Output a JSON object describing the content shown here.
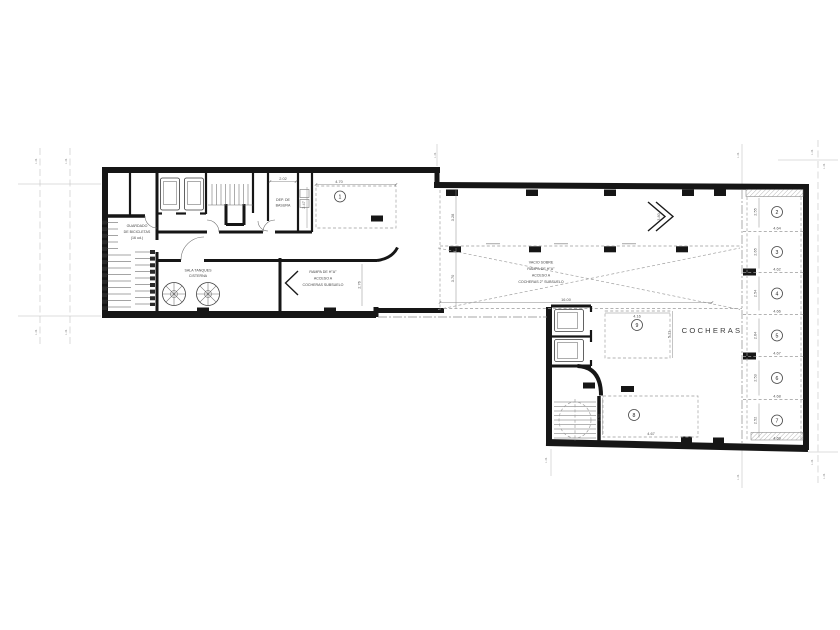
{
  "plan": {
    "rooms": {
      "bike1": "GUARDADO",
      "bike2": "DE BICICLETAS",
      "bike3": "(16 ud.)",
      "tanks1": "SALA TANQUES",
      "tanks2": "CISTERNA",
      "trash1": "DEP. DE",
      "trash2": "BASURA",
      "ramp1": "RAMPA DE H°A°",
      "ramp2": "ACCESO A",
      "ramp3": "COCHERAS SUBSUELO",
      "void1": "VACIO SOBRE",
      "void2": "RAMPA DE H°A°",
      "void3": "ACCESO A",
      "void4": "COCHERAS 2° SUBSUELO",
      "garage": "COCHERAS"
    },
    "spaces": [
      {
        "n": "1",
        "w": "4.70",
        "h": "2.47"
      },
      {
        "n": "2",
        "w": "4.64",
        "h": "2.55"
      },
      {
        "n": "3",
        "w": "4.62",
        "h": "2.65"
      },
      {
        "n": "4",
        "w": "4.66",
        "h": "2.54"
      },
      {
        "n": "5",
        "w": "4.67",
        "h": "2.64"
      },
      {
        "n": "6",
        "w": "4.68",
        "h": "2.53"
      },
      {
        "n": "7",
        "w": "4.69",
        "h": "2.52"
      },
      {
        "n": "8",
        "w": "4.67",
        "h": "2.50"
      },
      {
        "n": "9",
        "w": "4.16",
        "h": "5.11"
      }
    ],
    "dims": {
      "trash_w": "2.02",
      "upper_band": "3.28",
      "lower_band": "3.70",
      "ramp_w": "2.76",
      "ramp_len": "16.00",
      "ramp2_w": "3.80"
    },
    "markers": {
      "lm": "L.M."
    }
  }
}
